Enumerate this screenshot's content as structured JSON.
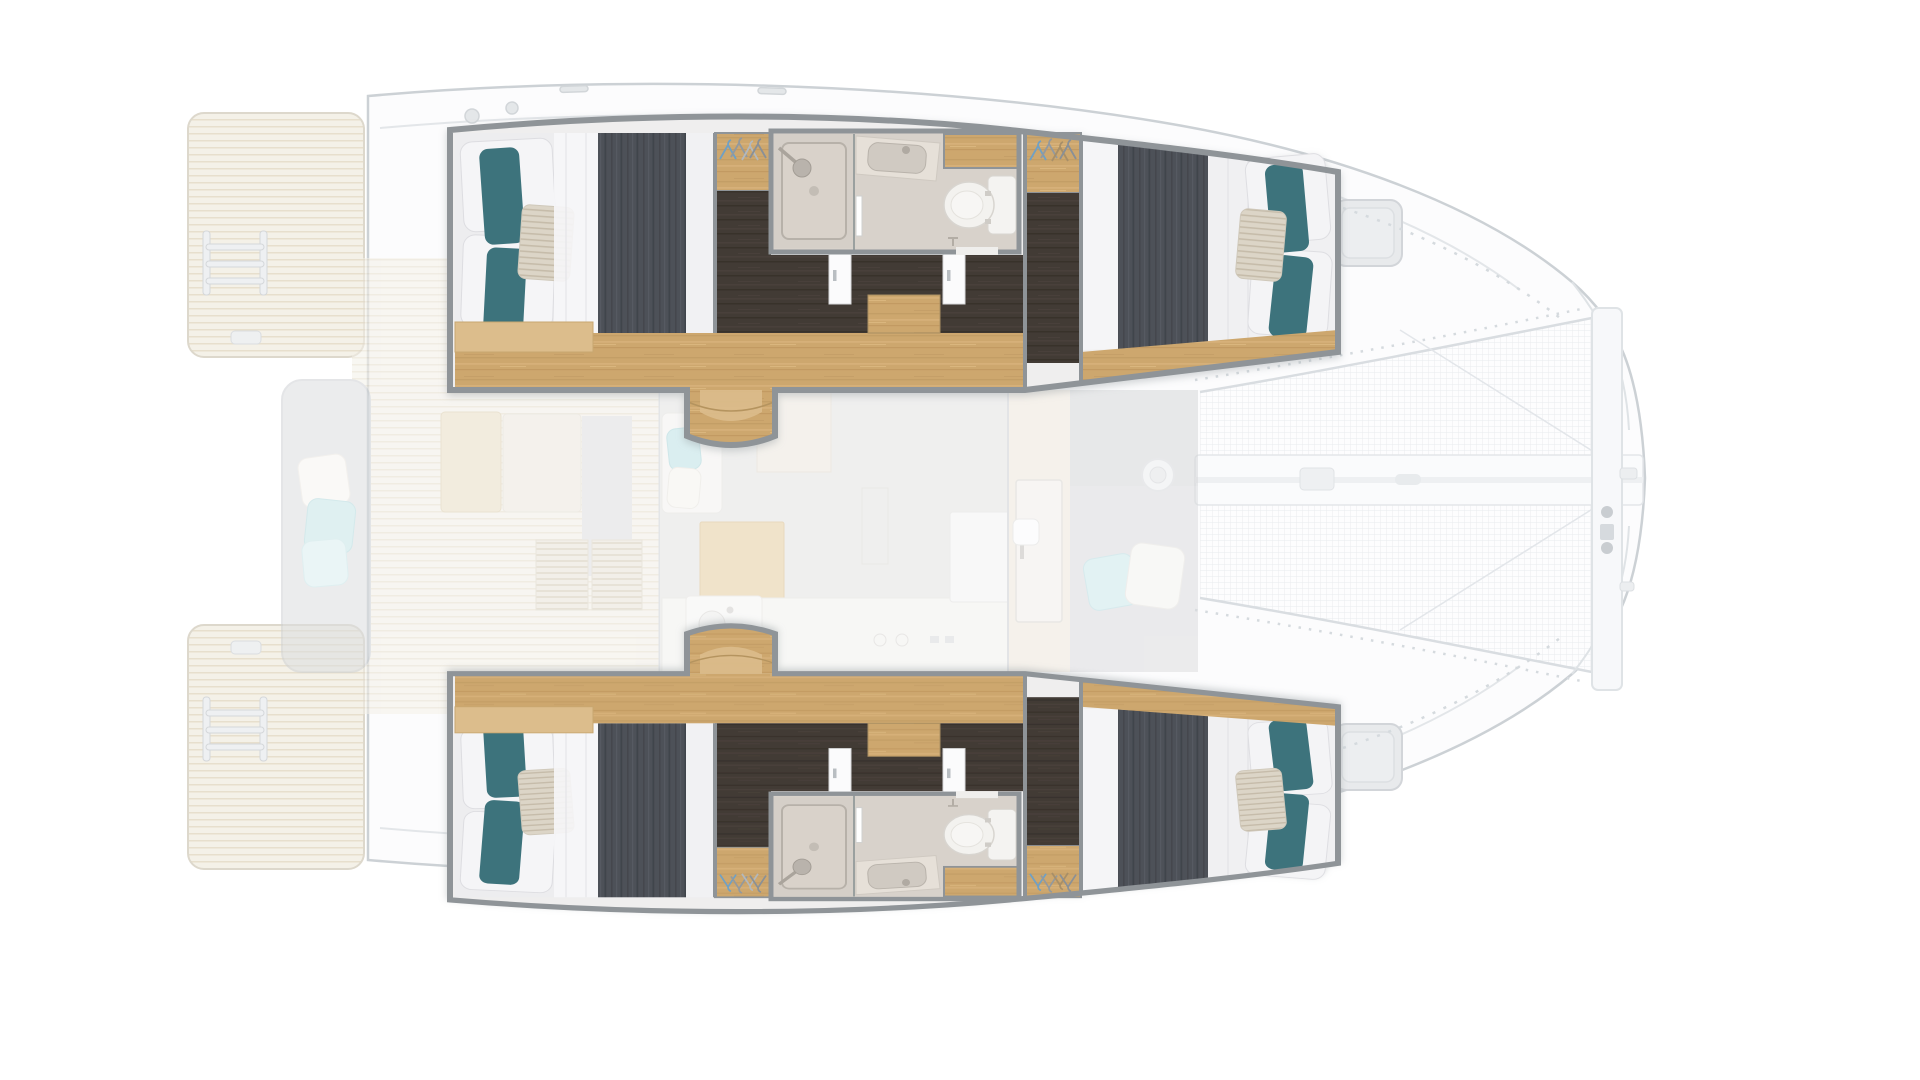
{
  "meta": {
    "title": "Catamaran deck plan - top-down interior layout",
    "view": "overhead floor plan",
    "style": "rendered 3D plan, hull cabins highlighted, saloon and decks faded"
  },
  "palette": {
    "teal_pillow": "#3e737c",
    "stripe_pillow": "#dcd5c7",
    "white_bedding": "#f0f0f2",
    "duvet_dark": "#4d5159",
    "wood_floor": "#cda76e",
    "wood_light": "#dcbd8c",
    "dark_walkway": "#423a34",
    "bath_wall": "#d8d2cb",
    "wall_gray": "#8f9498",
    "fixture_white": "#f4f3f1",
    "faded_teak": "#f4f1e8",
    "bench_gray": "#dcdee0",
    "cushion_cyan": "#c5e4e7",
    "net_line": "#e8ebee",
    "hull_outline": "#ccd1d5",
    "deck_white": "#fcfcfd",
    "hatch_gray": "#e8eaec"
  },
  "inventory": {
    "double_cabins": 4,
    "shower_rooms": 2,
    "toilets": 2,
    "wardrobes": 4,
    "swim_platforms": 2,
    "trampolines": 1
  },
  "legend": {
    "boat": "Catamaran hull outline",
    "hull_top": "Port hull - two double cabins with shower room and WC",
    "hull_bottom": "Starboard hull - two double cabins with shower room and WC",
    "aft_cabin": "Aft double cabin",
    "fwd_cabin": "Forward double cabin",
    "bathroom": "Shower room with vanity and separate WC",
    "wardrobe": "Hanging wardrobe",
    "stairs": "Companionway steps to saloon",
    "saloon": "Saloon and galley (faded)",
    "aft_cockpit": "Aft cockpit with bench, table and teak floor (faded)",
    "fwd_cockpit": "Forward cockpit lounge with winch and cushions (faded)",
    "trampoline": "Bow trampoline net",
    "beam": "Bowsprit and forward crossbeam",
    "platform_top": "Port swim platform with boarding ladder",
    "platform_bottom": "Starboard swim platform with boarding ladder",
    "hatch": "Deck hatch"
  }
}
